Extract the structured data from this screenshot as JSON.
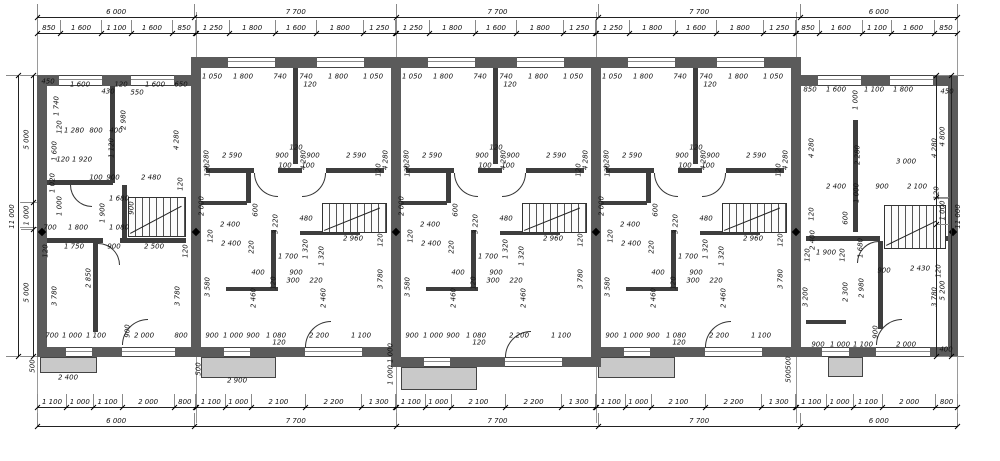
{
  "chains": {
    "top_totals": [
      [
        "6 000",
        6000
      ],
      [
        "7 700",
        7700
      ],
      [
        "7 700",
        7700
      ],
      [
        "7 700",
        7700
      ],
      [
        "6 000",
        6000
      ]
    ],
    "bottom_totals": [
      [
        "6 000",
        6000
      ],
      [
        "7 700",
        7700
      ],
      [
        "7 700",
        7700
      ],
      [
        "7 700",
        7700
      ],
      [
        "6 000",
        6000
      ]
    ],
    "top_subs_end": [
      [
        "850",
        850
      ],
      [
        "1 600",
        1600
      ],
      [
        "1 100",
        1100
      ],
      [
        "1 600",
        1600
      ],
      [
        "850",
        850
      ]
    ],
    "top_subs_mid": [
      [
        "1 250",
        1250
      ],
      [
        "1 800",
        1800
      ],
      [
        "1 600",
        1600
      ],
      [
        "1 800",
        1800
      ],
      [
        "1 250",
        1250
      ]
    ],
    "bottom_subs_end": [
      [
        "1 100",
        1100
      ],
      [
        "1 000",
        1000
      ],
      [
        "1 100",
        1100
      ],
      [
        "2 000",
        2000
      ],
      [
        "800",
        800
      ]
    ],
    "bottom_subs_mid": [
      [
        "1 100",
        1100
      ],
      [
        "1 000",
        1000
      ],
      [
        "2 100",
        2100
      ],
      [
        "2 200",
        2200
      ],
      [
        "1 300",
        1300
      ]
    ],
    "left_outer": [
      [
        "11 000",
        11000
      ]
    ],
    "left_inner": [
      [
        "5 000",
        5000
      ],
      [
        "1 000",
        1000
      ],
      [
        "5 000",
        5000
      ]
    ],
    "right_inner": [
      [
        "4 800",
        4800
      ],
      [
        "1 000",
        1000
      ],
      [
        "5 200",
        5200
      ]
    ],
    "right_outer": [
      [
        "11 000",
        11000
      ]
    ]
  },
  "labels": {
    "unit1": [
      [
        48,
        82,
        "450"
      ],
      [
        80,
        85,
        "1 600"
      ],
      [
        108,
        92,
        "430"
      ],
      [
        121,
        85,
        "120"
      ],
      [
        137,
        93,
        "550"
      ],
      [
        155,
        85,
        "1 600"
      ],
      [
        181,
        85,
        "650"
      ],
      [
        57,
        106,
        "1 740",
        1
      ],
      [
        60,
        127,
        "120",
        1
      ],
      [
        124,
        120,
        "2 980",
        1
      ],
      [
        177,
        140,
        "4 280",
        1
      ],
      [
        74,
        131,
        "1 280"
      ],
      [
        96,
        131,
        "800"
      ],
      [
        116,
        131,
        "400"
      ],
      [
        112,
        148,
        "1 120",
        1
      ],
      [
        55,
        151,
        "1 600",
        1
      ],
      [
        63,
        160,
        "120"
      ],
      [
        82,
        160,
        "1 920"
      ],
      [
        53,
        183,
        "1 020",
        1
      ],
      [
        96,
        178,
        "100"
      ],
      [
        113,
        178,
        "900"
      ],
      [
        151,
        178,
        "2 480"
      ],
      [
        181,
        184,
        "120",
        1
      ],
      [
        119,
        199,
        "1 680"
      ],
      [
        132,
        208,
        "900",
        1
      ],
      [
        60,
        206,
        "1 000",
        1
      ],
      [
        103,
        213,
        "1 900",
        1
      ],
      [
        50,
        228,
        "700"
      ],
      [
        78,
        228,
        "1 800"
      ],
      [
        119,
        228,
        "1 080"
      ],
      [
        46,
        251,
        "120",
        1
      ],
      [
        74,
        247,
        "1 750"
      ],
      [
        114,
        247,
        "900"
      ],
      [
        154,
        247,
        "2 500"
      ],
      [
        186,
        251,
        "120",
        1
      ],
      [
        89,
        278,
        "2 850",
        1
      ],
      [
        55,
        296,
        "3 780",
        1
      ],
      [
        178,
        296,
        "3 780",
        1
      ],
      [
        128,
        331,
        "900",
        1
      ],
      [
        52,
        336,
        "700"
      ],
      [
        72,
        336,
        "1 000"
      ],
      [
        96,
        336,
        "1 100"
      ],
      [
        144,
        336,
        "2 000"
      ],
      [
        181,
        336,
        "800"
      ]
    ],
    "mid_template": [
      [
        16,
        77,
        "1 050"
      ],
      [
        47,
        77,
        "1 800"
      ],
      [
        84,
        77,
        "740"
      ],
      [
        110,
        77,
        "740"
      ],
      [
        114,
        85,
        "120"
      ],
      [
        142,
        77,
        "1 800"
      ],
      [
        177,
        77,
        "1 050"
      ],
      [
        11,
        160,
        "4 280",
        1
      ],
      [
        108,
        160,
        "4 280",
        1
      ],
      [
        190,
        160,
        "4 280",
        1
      ],
      [
        36,
        156,
        "2 590"
      ],
      [
        86,
        156,
        "900"
      ],
      [
        100,
        148,
        "120"
      ],
      [
        89,
        166,
        "100"
      ],
      [
        112,
        166,
        "100"
      ],
      [
        117,
        156,
        "900"
      ],
      [
        160,
        156,
        "2 590"
      ],
      [
        12,
        170,
        "120",
        1
      ],
      [
        183,
        170,
        "120",
        1
      ],
      [
        6,
        206,
        "2 000",
        1
      ],
      [
        34,
        225,
        "2 400"
      ],
      [
        60,
        210,
        "600",
        1
      ],
      [
        80,
        224,
        "3 220",
        1
      ],
      [
        110,
        219,
        "480"
      ],
      [
        35,
        244,
        "2 400"
      ],
      [
        15,
        236,
        "120",
        1
      ],
      [
        56,
        247,
        "220",
        1
      ],
      [
        92,
        257,
        "1 700"
      ],
      [
        110,
        249,
        "1 320",
        1
      ],
      [
        126,
        256,
        "1 320",
        1
      ],
      [
        62,
        273,
        "400"
      ],
      [
        100,
        273,
        "900"
      ],
      [
        97,
        281,
        "300"
      ],
      [
        120,
        281,
        "220"
      ],
      [
        78,
        283,
        "120",
        1
      ],
      [
        12,
        287,
        "3 580",
        1
      ],
      [
        58,
        298,
        "2 460",
        1
      ],
      [
        128,
        298,
        "2 460",
        1
      ],
      [
        185,
        279,
        "3 780",
        1
      ],
      [
        157,
        239,
        "2 960"
      ],
      [
        185,
        240,
        "120",
        1
      ],
      [
        16,
        336,
        "900"
      ],
      [
        37,
        336,
        "1 000"
      ],
      [
        57,
        336,
        "900"
      ],
      [
        80,
        336,
        "1 080"
      ],
      [
        83,
        343,
        "120"
      ],
      [
        123,
        336,
        "2 200"
      ],
      [
        165,
        336,
        "1 100"
      ]
    ],
    "mid_offsets": [
      196,
      396,
      596
    ],
    "unit5": [
      [
        810,
        90,
        "850"
      ],
      [
        836,
        90,
        "1 600"
      ],
      [
        856,
        100,
        "1 000",
        1
      ],
      [
        874,
        90,
        "1 100"
      ],
      [
        903,
        90,
        "1 800"
      ],
      [
        947,
        92,
        "450"
      ],
      [
        812,
        148,
        "4 280",
        1
      ],
      [
        858,
        155,
        "2 280",
        1
      ],
      [
        935,
        148,
        "4 280",
        1
      ],
      [
        906,
        162,
        "3 000"
      ],
      [
        836,
        187,
        "2 400"
      ],
      [
        857,
        193,
        "1 000",
        1
      ],
      [
        882,
        187,
        "900"
      ],
      [
        917,
        187,
        "2 100"
      ],
      [
        937,
        193,
        "120",
        1
      ],
      [
        812,
        214,
        "120",
        1
      ],
      [
        813,
        240,
        "2 400",
        1
      ],
      [
        846,
        218,
        "600",
        1
      ],
      [
        861,
        248,
        "1 680",
        1
      ],
      [
        826,
        253,
        "1 900"
      ],
      [
        808,
        255,
        "120",
        1
      ],
      [
        843,
        255,
        "120",
        1
      ],
      [
        884,
        271,
        "900"
      ],
      [
        920,
        269,
        "2 430"
      ],
      [
        939,
        271,
        "120",
        1
      ],
      [
        806,
        297,
        "3 200",
        1
      ],
      [
        846,
        292,
        "2 300",
        1
      ],
      [
        862,
        288,
        "2 980",
        1
      ],
      [
        935,
        297,
        "3 780",
        1
      ],
      [
        876,
        332,
        "900",
        1
      ],
      [
        818,
        345,
        "900"
      ],
      [
        840,
        345,
        "1 000"
      ],
      [
        863,
        345,
        "1 100"
      ],
      [
        906,
        345,
        "2 000"
      ],
      [
        946,
        350,
        "400"
      ]
    ],
    "extras": [
      [
        68,
        378,
        "2 400"
      ],
      [
        33,
        366,
        "500",
        1
      ],
      [
        237,
        381,
        "2 900"
      ],
      [
        199,
        369,
        "500",
        1
      ],
      [
        391,
        353,
        "1 000",
        1
      ],
      [
        391,
        375,
        "1 000",
        1
      ],
      [
        789,
        363,
        "500",
        1
      ],
      [
        789,
        376,
        "500",
        1
      ]
    ]
  }
}
